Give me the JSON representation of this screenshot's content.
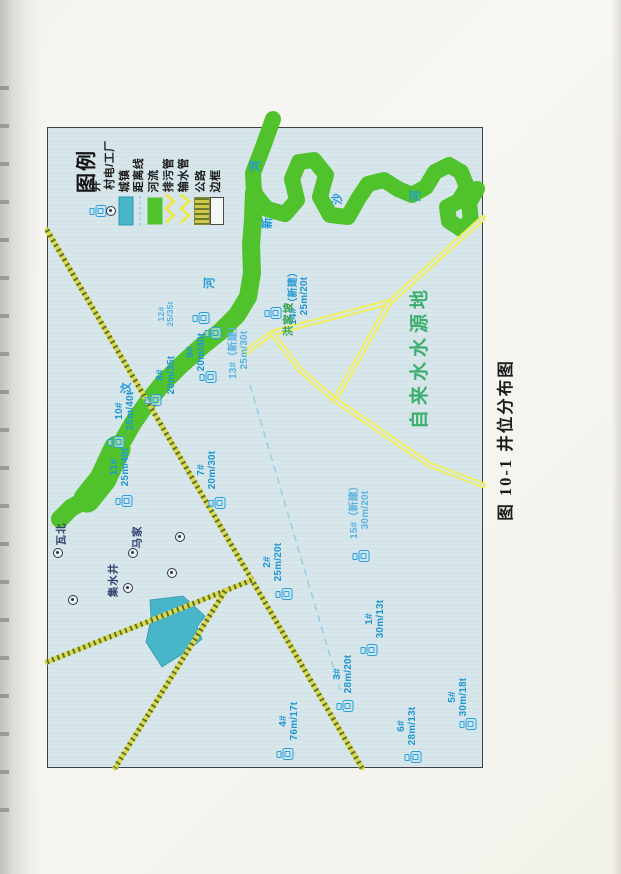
{
  "page": {
    "caption": "图 10-1 井位分布图"
  },
  "colors": {
    "map_background": "#d7e6ea",
    "river_green": "#50c22c",
    "road_yellow": "#f2ee4f",
    "road_olive": "#dcd952",
    "well_blue": "#2b9fd8",
    "town_cyan": "#48b5c9",
    "distance_line_blue": "#97d0e4",
    "source_area_green": "#3cae6e"
  },
  "legend": {
    "title": "图例",
    "items": [
      {
        "label": "井",
        "symbol": "well-icon",
        "x": 97
      },
      {
        "label": "村电/工厂",
        "symbol": "village-symbol",
        "x": 111
      },
      {
        "label": "城镇",
        "symbol": "town-swatch",
        "x": 126
      },
      {
        "label": "距离线",
        "symbol": "distance-line",
        "x": 140
      },
      {
        "label": "河流",
        "symbol": "river-swatch",
        "x": 155
      },
      {
        "label": "排污管",
        "symbol": "sewage-pipe",
        "x": 170
      },
      {
        "label": "输水管",
        "symbol": "water-pipe",
        "x": 185
      },
      {
        "label": "公路",
        "symbol": "road-swatch",
        "x": 202
      },
      {
        "label": "边框",
        "symbol": "border-swatch",
        "x": 217
      }
    ]
  },
  "map_data": {
    "wells": [
      {
        "id": "11#",
        "spec": "25m/40t",
        "label_x": 121,
        "label_y": 467,
        "icon_x": 127,
        "icon_y": 501,
        "style": ""
      },
      {
        "id": "10#",
        "spec": "25m/40t",
        "label_x": 126,
        "label_y": 411,
        "icon_x": 119,
        "icon_y": 442,
        "style": ""
      },
      {
        "id": "8#",
        "spec": "20m/35t",
        "label_x": 167,
        "label_y": 375,
        "icon_x": 156,
        "icon_y": 400,
        "style": ""
      },
      {
        "id": "12#",
        "spec": "25/35t",
        "label_x": 166,
        "label_y": 314,
        "icon_x": 204,
        "icon_y": 318,
        "style": "light small"
      },
      {
        "id": "9#",
        "spec": "20m/40t",
        "label_x": 197,
        "label_y": 352,
        "icon_x": 216,
        "icon_y": 333,
        "style": ""
      },
      {
        "id": "13#（新建）",
        "spec": "25m/30t",
        "label_x": 240,
        "label_y": 350,
        "icon_x": 211,
        "icon_y": 377,
        "style": "light"
      },
      {
        "id": "14#（新建）",
        "spec": "25m/20t",
        "label_x": 300,
        "label_y": 296,
        "icon_x": 276,
        "icon_y": 313,
        "style": ""
      },
      {
        "id": "15#（新建）",
        "spec": "30m/20t",
        "label_x": 361,
        "label_y": 510,
        "icon_x": 364,
        "icon_y": 556,
        "style": "light"
      },
      {
        "id": "7#",
        "spec": "20m/30t",
        "label_x": 208,
        "label_y": 470,
        "icon_x": 220,
        "icon_y": 503,
        "style": ""
      },
      {
        "id": "2#",
        "spec": "25m/20t",
        "label_x": 274,
        "label_y": 562,
        "icon_x": 287,
        "icon_y": 594,
        "style": ""
      },
      {
        "id": "1#",
        "spec": "30m/13t",
        "label_x": 376,
        "label_y": 619,
        "icon_x": 372,
        "icon_y": 650,
        "style": ""
      },
      {
        "id": "3#",
        "spec": "28m/20t",
        "label_x": 344,
        "label_y": 674,
        "icon_x": 348,
        "icon_y": 706,
        "style": ""
      },
      {
        "id": "4#",
        "spec": "76m/17t",
        "label_x": 290,
        "label_y": 721,
        "icon_x": 288,
        "icon_y": 754,
        "style": ""
      },
      {
        "id": "6#",
        "spec": "28m/13t",
        "label_x": 408,
        "label_y": 726,
        "icon_x": 416,
        "icon_y": 757,
        "style": ""
      },
      {
        "id": "5#",
        "spec": "30m/18t",
        "label_x": 459,
        "label_y": 697,
        "icon_x": 471,
        "icon_y": 724,
        "style": ""
      }
    ],
    "village_symbols": [
      {
        "x": 58,
        "y": 553
      },
      {
        "x": 73,
        "y": 600
      },
      {
        "x": 128,
        "y": 588
      },
      {
        "x": 133,
        "y": 553
      },
      {
        "x": 172,
        "y": 573
      },
      {
        "x": 180,
        "y": 537
      }
    ],
    "place_labels": [
      {
        "text": "瓦北",
        "x": 62,
        "y": 534,
        "cls": "navy-label",
        "name": "village-name-wabei"
      },
      {
        "text": "马家",
        "x": 138,
        "y": 537,
        "cls": "navy-label",
        "name": "village-name-majia"
      },
      {
        "text": "集水井",
        "x": 114,
        "y": 580,
        "cls": "navy-label",
        "name": "label-collector-well"
      },
      {
        "text": "洪家坡",
        "x": 289,
        "y": 319,
        "cls": "green-label",
        "name": "village-name-hongjiapo"
      },
      {
        "text": "自来水水源地",
        "x": 421,
        "y": 357,
        "cls": "source-label",
        "name": "label-water-source-area"
      },
      {
        "text": "汶",
        "x": 127,
        "y": 388,
        "cls": "river-label",
        "name": "river-name-char"
      },
      {
        "text": "河",
        "x": 210,
        "y": 283,
        "cls": "river-label",
        "name": "river-name-char"
      },
      {
        "text": "河",
        "x": 256,
        "y": 166,
        "cls": "river-label",
        "name": "river-name-char"
      },
      {
        "text": "新",
        "x": 268,
        "y": 223,
        "cls": "river-label",
        "name": "river-name-char"
      },
      {
        "text": "沙",
        "x": 338,
        "y": 199,
        "cls": "river-label",
        "name": "river-name-char"
      },
      {
        "text": "河",
        "x": 416,
        "y": 196,
        "cls": "river-label",
        "name": "river-name-char"
      }
    ]
  }
}
